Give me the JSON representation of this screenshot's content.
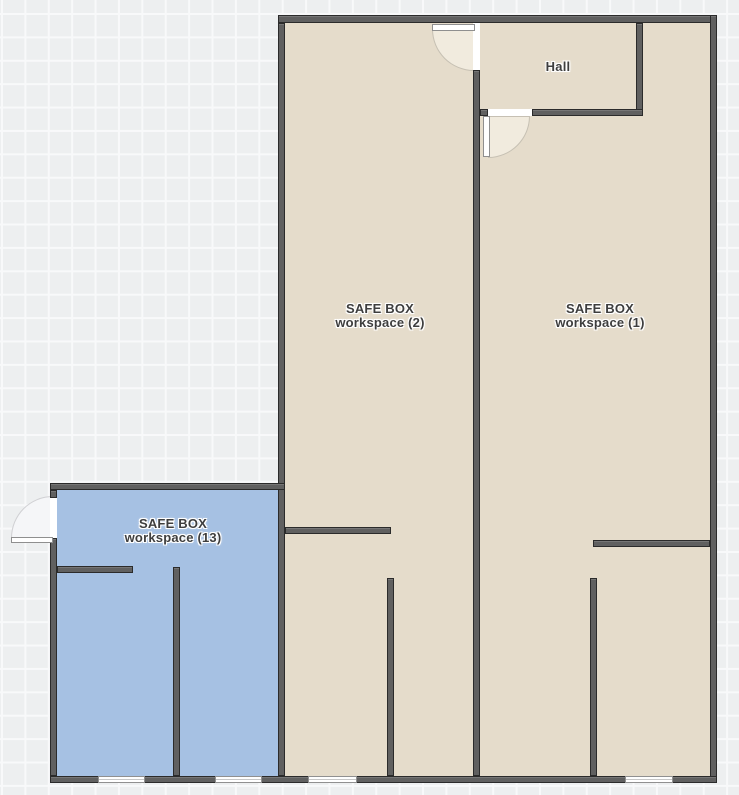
{
  "canvas": {
    "type": "floor-plan-editor-canvas",
    "grid": "on"
  },
  "rooms": {
    "workspace2": {
      "line1": "SAFE BOX",
      "line2": "workspace (2)",
      "highlighted": false
    },
    "workspace1": {
      "line1": "SAFE BOX",
      "line2": "workspace (1)",
      "highlighted": false
    },
    "hall": {
      "label": "Hall",
      "highlighted": false
    },
    "workspace13": {
      "line1": "SAFE BOX",
      "line2": "workspace (13)",
      "highlighted": true
    }
  },
  "colors": {
    "canvas_bg": "#edeff0",
    "grid_line": "#f8f9fa",
    "room_fill": "#e5dccb",
    "room_fill_selected": "#a6c1e3",
    "wall": "#606060",
    "wall_border": "#2b2b2b",
    "door_swing": "#f1ebde",
    "label_text": "#3e3e3e"
  }
}
